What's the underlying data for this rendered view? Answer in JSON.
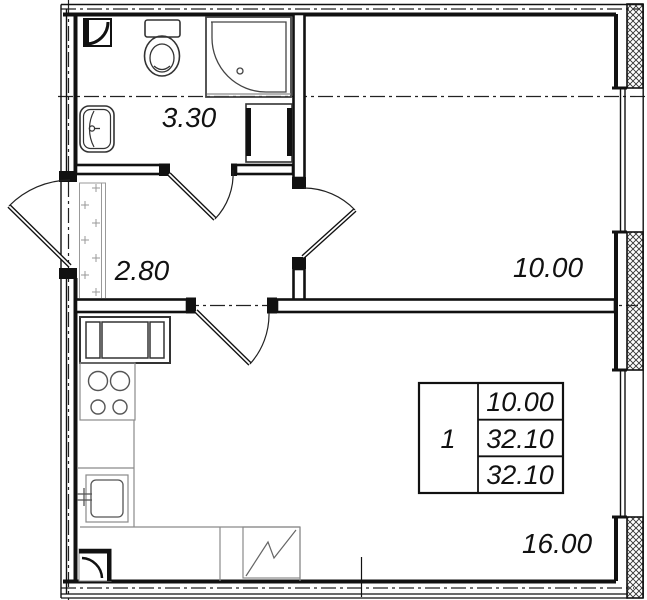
{
  "drawing": {
    "type": "apartment floor plan",
    "room_labels": {
      "bathroom": "3.30",
      "hallway": "2.80",
      "room": "10.00",
      "kitchen_living": "16.00"
    },
    "info_table": {
      "rooms_count": "1",
      "rows": [
        "10.00",
        "32.10",
        "32.10"
      ]
    },
    "colors": {
      "line": "#111111",
      "fixture_line": "#333333",
      "furniture_line": "#8a8a8a",
      "background": "#ffffff"
    }
  }
}
